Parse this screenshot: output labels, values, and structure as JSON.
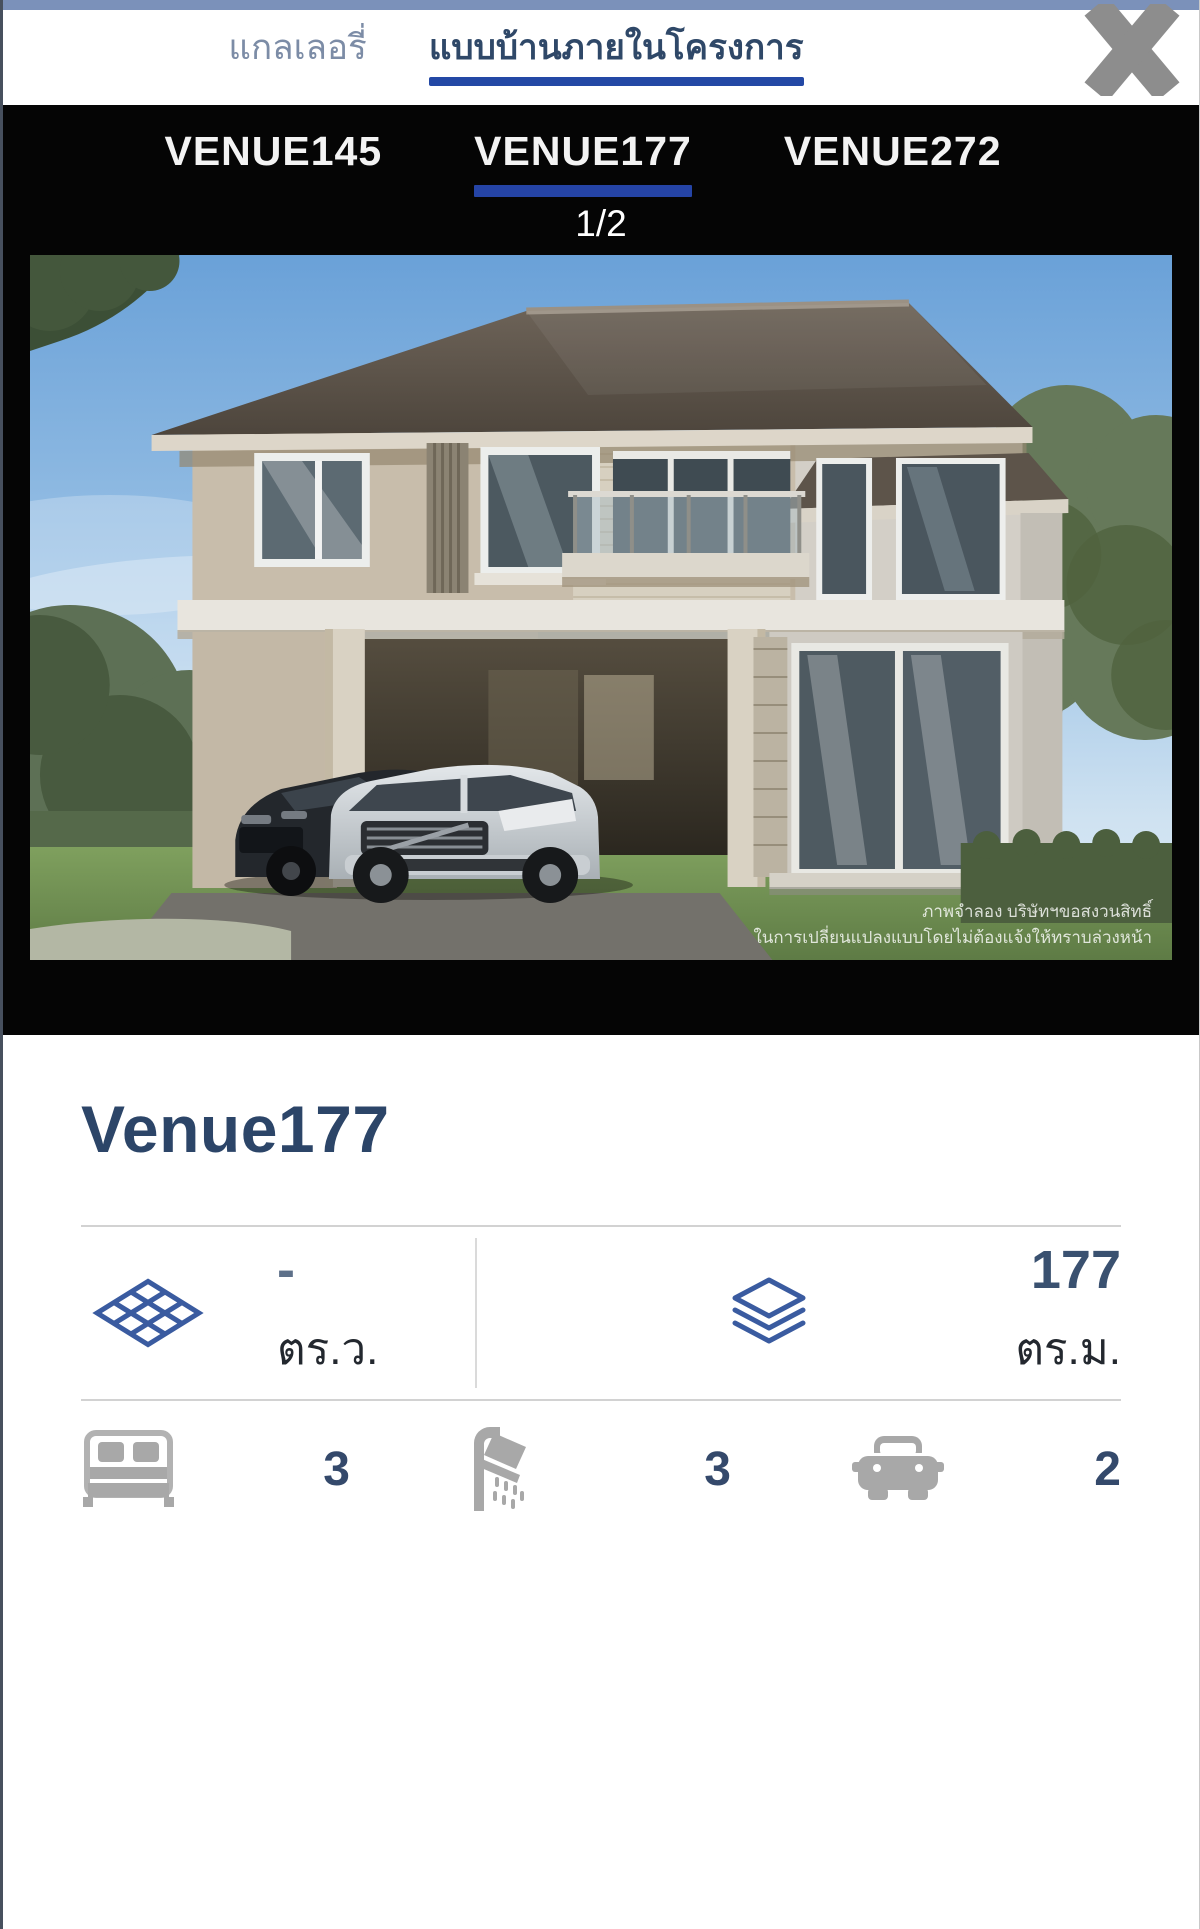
{
  "colors": {
    "top_strip": "#7b91ba",
    "header_active_underline": "#2348a5",
    "venue_active_underline": "#2544a6",
    "black_bar": "#050505",
    "title_color": "#2c4568",
    "stat_icon_blue": "#3a5ba0",
    "amenity_icon_gray": "#a8a8a8"
  },
  "header": {
    "tabs": [
      {
        "label": "แกลเลอรี่",
        "active": false
      },
      {
        "label": "แบบบ้านภายในโครงการ",
        "active": true
      }
    ],
    "close_icon": "close-x-icon"
  },
  "venue_bar": {
    "tabs": [
      {
        "label": "VENUE145",
        "active": false
      },
      {
        "label": "VENUE177",
        "active": true
      },
      {
        "label": "VENUE272",
        "active": false
      }
    ],
    "pagination": "1/2"
  },
  "gallery_image": {
    "watermark_line1": "ภาพจำลอง บริษัทฯขอสงวนสิทธิ์",
    "watermark_line2": "ในการเปลี่ยนแปลงแบบโดยไม่ต้องแจ้งให้ทราบล่วงหน้า"
  },
  "details": {
    "title": "Venue177",
    "stats": [
      {
        "icon": "floor-tiles-icon",
        "value": "-",
        "unit": "ตร.ว."
      },
      {
        "icon": "layers-icon",
        "value": "177",
        "unit": "ตร.ม."
      }
    ],
    "amenities": [
      {
        "icon": "bed-icon",
        "count": "3"
      },
      {
        "icon": "shower-icon",
        "count": "3"
      },
      {
        "icon": "car-icon",
        "count": "2"
      }
    ]
  }
}
